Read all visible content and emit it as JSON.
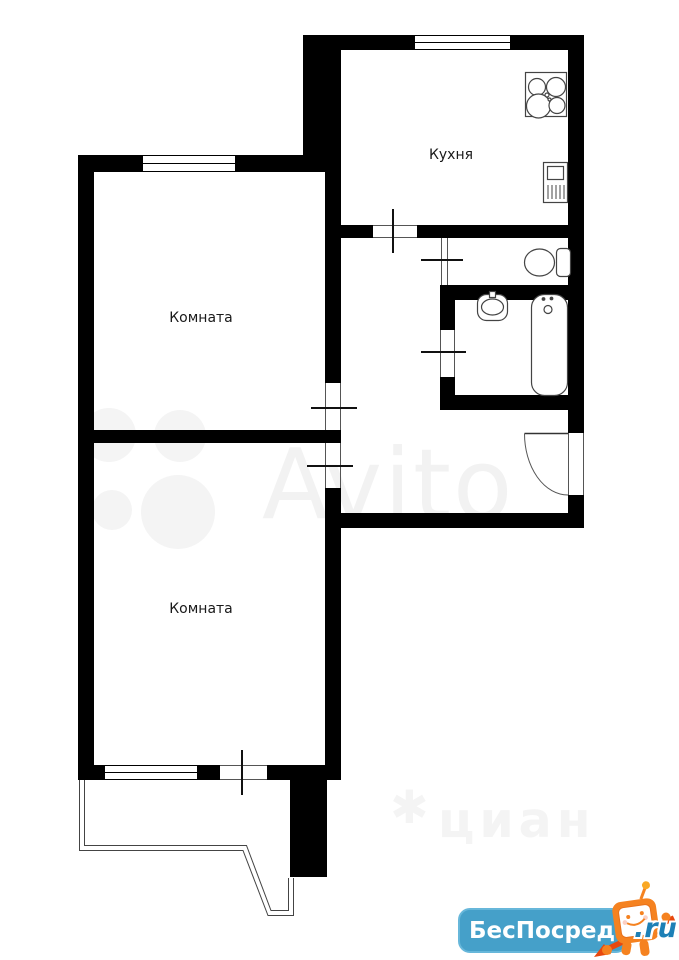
{
  "floorplan": {
    "rooms": [
      {
        "id": "kitchen",
        "label": "Кухня"
      },
      {
        "id": "room-top",
        "label": "Комната"
      },
      {
        "id": "room-bottom",
        "label": "Комната"
      }
    ],
    "wall_color": "#000000",
    "line_color": "#444444"
  },
  "watermarks": {
    "avito": {
      "text": "Avito",
      "color": "#f2f2f2"
    },
    "cian": {
      "star": "✱",
      "text": "циан",
      "color": "#f4f4f4"
    },
    "badge": {
      "title": "БесПосредника",
      "suffix": ".ru",
      "bg_color": "#45a0c9",
      "title_color": "#ffffff",
      "mascot_color": "#f58220"
    }
  }
}
